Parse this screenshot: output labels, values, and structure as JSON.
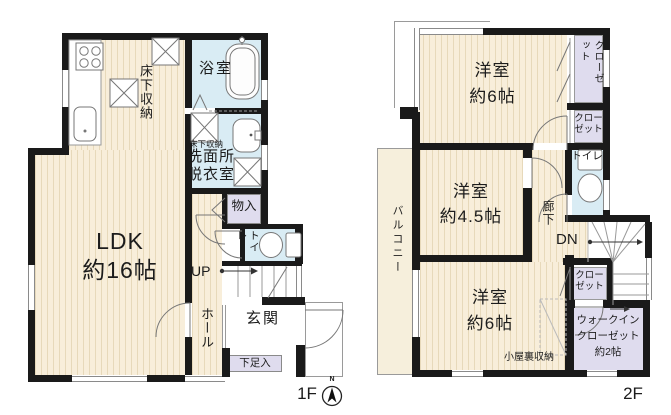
{
  "title": "間取り図",
  "colors": {
    "wall": "#1a1a1a",
    "floor": "#f8eeda",
    "stripe": "#e7d9ba",
    "wet": "#d9ecf4",
    "closet": "#dfdcee",
    "line": "#999999",
    "ink": "#1c1c1c",
    "balcony": "#f6efdc"
  },
  "f1": {
    "floor_label": "1F",
    "compass_n": "N",
    "ldk": "LDK\n約16帖",
    "underfloor": "床下収納",
    "underfloor_small": "床下収納",
    "bath": "浴室",
    "washroom": "洗面所\n脱衣室",
    "closet": "物入",
    "toilet": "トイレ",
    "up": "UP",
    "hall": "ホール",
    "entrance": "玄関",
    "shoe": "下足入"
  },
  "f2": {
    "floor_label": "2F",
    "bedroom6_top": "洋室\n約6帖",
    "closet_top": "クローゼット",
    "closet_mid": "クロー\nゼット",
    "toilet": "トイレ",
    "bedroom45": "洋室\n約4.5帖",
    "hallway": "廊下",
    "dn": "DN",
    "balcony": "バルコニー",
    "bedroom6_bottom": "洋室\n約6帖",
    "attic": "小屋裏収納",
    "closet_small": "クロー\nゼット",
    "wic": "ウォークイン\nクローゼット\n約2帖"
  }
}
